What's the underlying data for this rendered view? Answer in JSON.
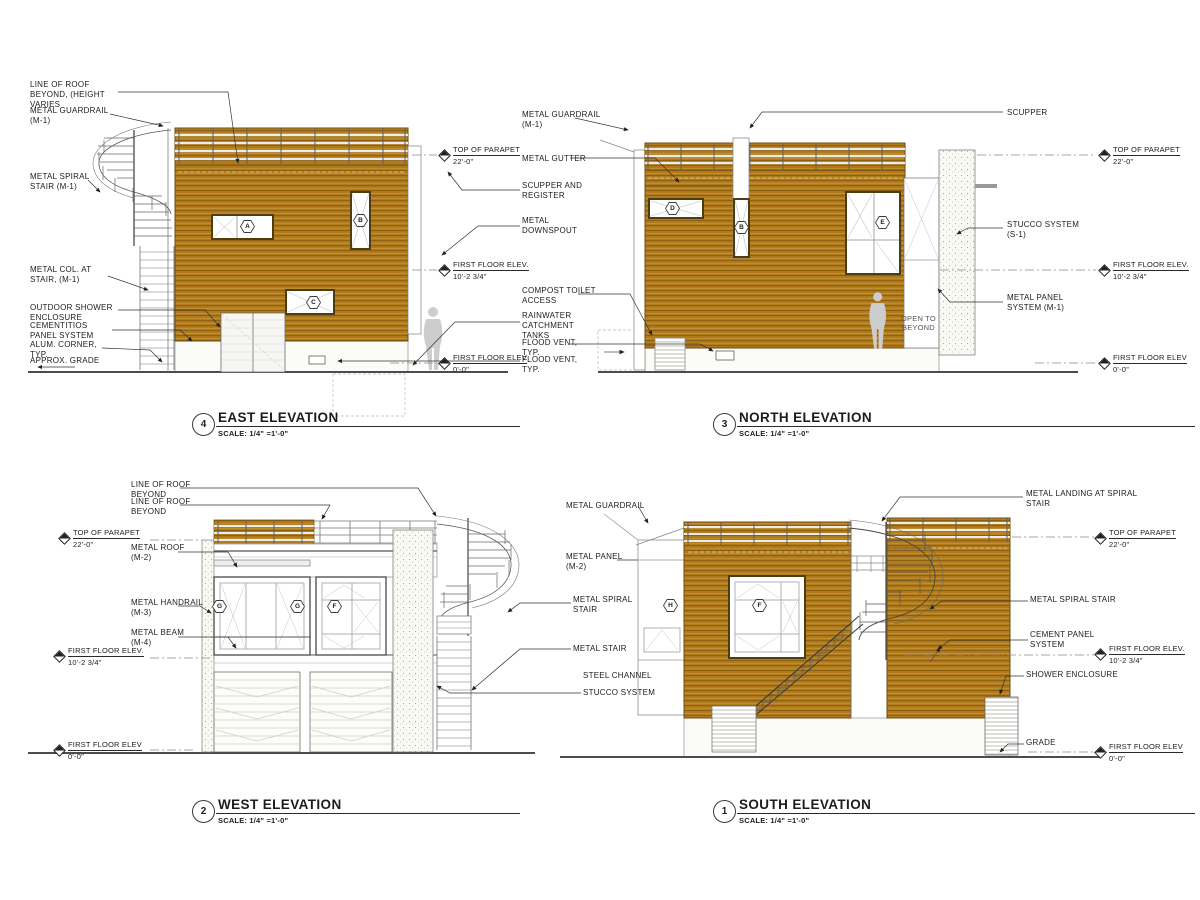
{
  "sheet": {
    "east": {
      "number": "4",
      "title": "EAST ELEVATION",
      "scale": "SCALE: 1/4\" =1'-0\"",
      "labels": {
        "roof_line": "LINE OF ROOF\nBEYOND, (HEIGHT\nVARIES",
        "guardrail": "METAL GUARDRAIL\n(M-1)",
        "spiral_stair": "METAL SPIRAL\nSTAIR (M-1)",
        "col_at_stair": "METAL COL. AT\nSTAIR, (M-1)",
        "outdoor_shower": "OUTDOOR SHOWER\nENCLOSURE",
        "cement_panel": "CEMENTITIOS\nPANEL SYSTEM",
        "alum_corner": "ALUM. CORNER,\nTYP.",
        "approx_grade": "APPROX. GRADE"
      },
      "tags": {
        "a": "A",
        "b": "B",
        "c": "C"
      },
      "markers": {
        "parapet": {
          "label": "TOP OF PARAPET",
          "value": "22'-0\""
        },
        "floor2": {
          "label": "FIRST FLOOR ELEV.",
          "value": "10'-2 3/4\""
        },
        "floor1": {
          "label": "FIRST FLOOR ELEV",
          "value": "0'-0\""
        }
      }
    },
    "north": {
      "number": "3",
      "title": "NORTH ELEVATION",
      "scale": "SCALE: 1/4\" =1'-0\"",
      "labels": {
        "guardrail": "METAL GUARDRAIL\n(M-1)",
        "gutter": "METAL GUTTER",
        "scupper_register": "SCUPPER AND\nREGISTER",
        "downspout": "METAL\nDOWNSPOUT",
        "compost": "COMPOST TOILET\nACCESS",
        "rainwater": "RAINWATER\nCATCHMENT\nTANKS",
        "flood_vent_1": "FLOOD VENT,\nTYP.",
        "flood_vent_2": "FLOOD VENT,\nTYP.",
        "scupper": "SCUPPER",
        "stucco": "STUCCO SYSTEM\n(S-1)",
        "metal_panel": "METAL PANEL\nSYSTEM (M-1)",
        "open_beyond": "OPEN TO\nBEYOND"
      },
      "tags": {
        "d": "D",
        "b": "B",
        "e": "E"
      },
      "markers": {
        "parapet": {
          "label": "TOP OF PARAPET",
          "value": "22'-0\""
        },
        "floor2": {
          "label": "FIRST FLOOR ELEV.",
          "value": "10'-2 3/4\""
        },
        "floor1": {
          "label": "FIRST FLOOR ELEV",
          "value": "0'-0\""
        }
      }
    },
    "west": {
      "number": "2",
      "title": "WEST ELEVATION",
      "scale": "SCALE: 1/4\" =1'-0\"",
      "labels": {
        "roof_beyond_1": "LINE OF ROOF\nBEYOND",
        "roof_beyond_2": "LINE OF ROOF\nBEYOND",
        "metal_roof": "METAL ROOF\n(M-2)",
        "handrail": "METAL HANDRAIL\n(M-3)",
        "beam": "METAL BEAM\n(M-4)",
        "guardrail": "METAL GUARDRAIL",
        "metal_panel": "METAL PANEL\n(M-2)",
        "spiral_stair": "METAL SPIRAL\nSTAIR",
        "metal_stair": "METAL STAIR",
        "steel_channel": "STEEL CHANNEL",
        "stucco": "STUCCO SYSTEM"
      },
      "tags": {
        "g1": "G",
        "g2": "G",
        "f": "F"
      },
      "markers": {
        "parapet": {
          "label": "TOP OF PARAPET",
          "value": "22'-0\""
        },
        "floor2": {
          "label": "FIRST FLOOR ELEV.",
          "value": "10'-2 3/4\""
        },
        "floor1": {
          "label": "FIRST FLOOR ELEV",
          "value": "0'-0\""
        }
      }
    },
    "south": {
      "number": "1",
      "title": "SOUTH ELEVATION",
      "scale": "SCALE: 1/4\" =1'-0\"",
      "labels": {
        "landing": "METAL LANDING AT SPIRAL\nSTAIR",
        "spiral_stair": "METAL SPIRAL STAIR",
        "cement_panel": "CEMENT PANEL\nSYSTEM",
        "shower": "SHOWER ENCLOSURE",
        "grade": "GRADE"
      },
      "tags": {
        "h": "H",
        "f": "F"
      },
      "markers": {
        "parapet": {
          "label": "TOP OF PARAPET",
          "value": "22'-0\""
        },
        "floor2": {
          "label": "FIRST FLOOR ELEV.",
          "value": "10'-2 3/4\""
        },
        "floor1": {
          "label": "FIRST FLOOR ELEV",
          "value": "0'-0\""
        }
      }
    }
  }
}
